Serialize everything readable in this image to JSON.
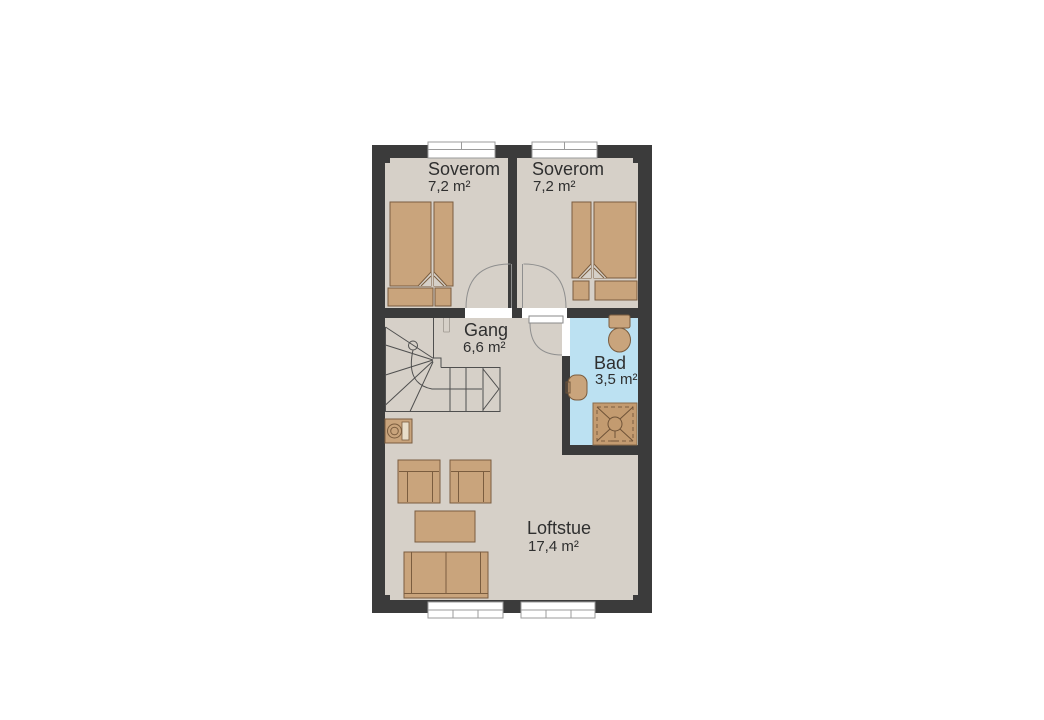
{
  "plan": {
    "type": "floor-plan",
    "language": "Norwegian",
    "rooms": [
      {
        "id": "bedroom-1",
        "name": "Soverom",
        "area": "7,2 m²",
        "furniture": [
          "double-bed"
        ]
      },
      {
        "id": "bedroom-2",
        "name": "Soverom",
        "area": "7,2 m²",
        "furniture": [
          "double-bed"
        ]
      },
      {
        "id": "hallway",
        "name": "Gang",
        "area": "6,6 m²",
        "furniture": [
          "staircase",
          "washing-machine"
        ]
      },
      {
        "id": "bathroom",
        "name": "Bad",
        "area": "3,5 m²",
        "furniture": [
          "toilet",
          "sink",
          "shower"
        ]
      },
      {
        "id": "loft-living-room",
        "name": "Loftstue",
        "area": "17,4 m²",
        "furniture": [
          "armchair",
          "armchair",
          "coffee-table",
          "sofa"
        ]
      }
    ],
    "window_count": 4,
    "door_count": 3,
    "colors": {
      "wall": "#3b3b3b",
      "floor": "#d6d0c8",
      "bathroom_floor": "#bce1f2",
      "furniture_fill": "#c9a47c",
      "furniture_outline": "#7b5d3f",
      "stair_line": "#4f4f4f",
      "door_swing": "#8f8f8f",
      "window_frame": "#9b9b9b",
      "label_text": "#2f2f2f",
      "background": "#ffffff"
    }
  }
}
